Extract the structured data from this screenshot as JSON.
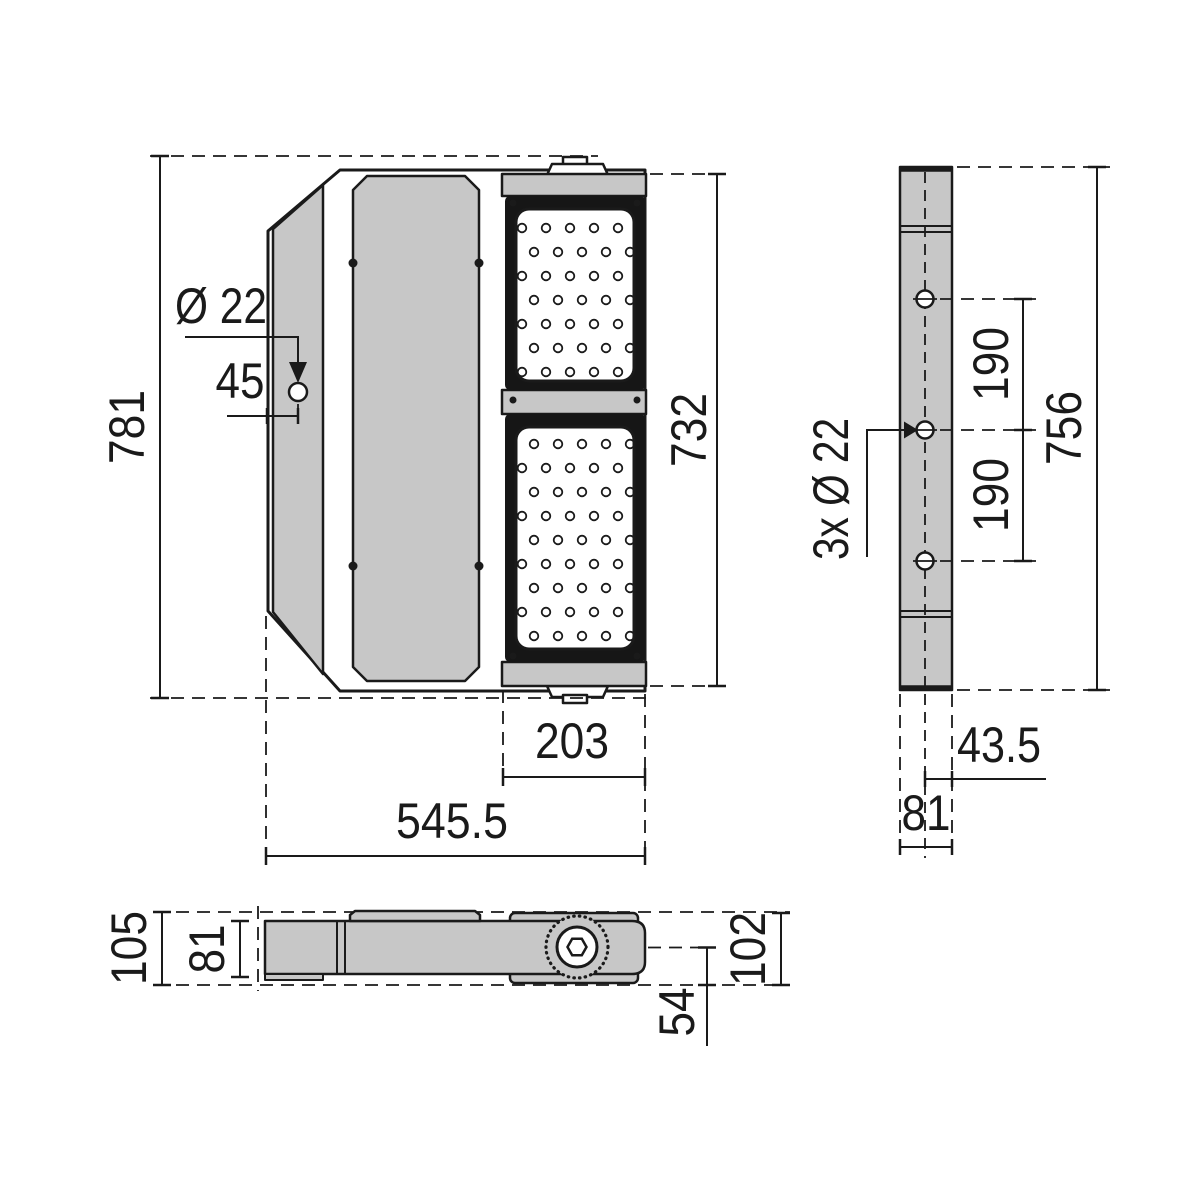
{
  "drawing": {
    "type": "luminaire dimensional drawing",
    "units": "mm",
    "views": {
      "front": {
        "overall_height": "781",
        "module_height": "732",
        "overall_width": "545.5",
        "module_width": "203",
        "hole_diameter": "Ø 22",
        "hole_edge_offset": "45"
      },
      "side": {
        "overall_height": "756",
        "hole_spacing_upper": "190",
        "hole_spacing_lower": "190",
        "holes_label": "3x Ø 22",
        "hole_plane_offset": "43.5",
        "housing_depth": "81"
      },
      "bottom": {
        "overall_depth": "105",
        "housing_depth": "81",
        "bracket_height": "102",
        "pivot_offset": "54"
      }
    }
  },
  "colors": {
    "line": "#1a1a1a",
    "fill": "#c7c7c7",
    "background": "#ffffff"
  }
}
